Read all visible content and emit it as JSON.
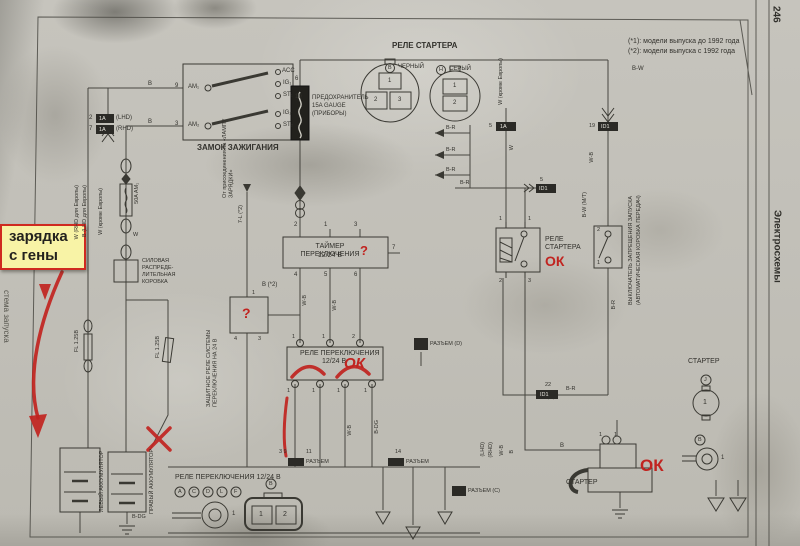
{
  "page": {
    "number": "246",
    "side_title": "Электросхемы",
    "left_edge_note": "стема запуска",
    "note1": "(*1): модели выпуска до 1992 года",
    "note2": "(*2): модели выпуска с 1992 года"
  },
  "sticky": {
    "line1": "зарядка",
    "line2": "с гены"
  },
  "red": {
    "ok": "ОК",
    "q": "?"
  },
  "ignition": {
    "title": "ЗАМОК ЗАЖИГАНИЯ",
    "am1": "AM₁",
    "am2": "AM₂",
    "acc": "ACC",
    "ig1": "IG₁",
    "st1": "ST₁",
    "ig2": "IG₂",
    "st2": "ST₂",
    "pin9": "9",
    "pin3": "3",
    "pin6": "6",
    "pin10": "10",
    "wire_b1": "B",
    "wire_b2": "B",
    "conn1": "2",
    "conn2": "7",
    "conn_name": "1A",
    "lhd": "(LHD)",
    "rhd": "(RHD)"
  },
  "fuse": {
    "name": "ПРЕДОХРАНИТЕЛЬ",
    "rating": "15A GAUGE",
    "note": "(ПРИБОРЫ)"
  },
  "relay_conn": {
    "title": "РЕЛЕ СТАРТЕРА",
    "black_l": "B",
    "black": "ЧЕРНЫЙ",
    "gray_l": "H",
    "gray": "СЕРЫЙ",
    "p1": "1",
    "p2": "2",
    "p3": "3",
    "q1": "1",
    "q2": "2",
    "side": "W (кроме Европы)"
  },
  "timer": {
    "name1": "ТАЙМЕР ПЕРЕКЛЮЧЕНИЯ",
    "name2": "12/24 В",
    "t1": "2",
    "t2": "1",
    "t3": "3",
    "b1": "4",
    "b2": "5",
    "b3": "6",
    "r1": "7",
    "note": "B (*2)"
  },
  "guard": {
    "name": "ЗАЩИТНОЕ РЕЛЕ СИСТЕМЫ ПЕРЕКЛЮЧЕНИЯ НА 24 В",
    "from": "От присоединения на «ЛАМПУ ЗАРЯДКИ»",
    "wire": "7-L (*2)",
    "p1": "1",
    "p4": "4",
    "p3": "3"
  },
  "swrelay": {
    "name1": "РЕЛЕ ПЕРЕКЛЮЧЕНИЯ",
    "name2": "12/24 В",
    "t1": "1",
    "t2": "1",
    "t3": "2",
    "b1": "1",
    "b2": "1",
    "b3": "1",
    "b4": "1"
  },
  "strelay": {
    "name1": "РЕЛЕ",
    "name2": "СТАРТЕРА",
    "p1": "1",
    "p2": "1",
    "p3": "2",
    "p4": "3"
  },
  "nswitch": {
    "name1": "ВЫКЛЮЧАТЕЛЬ ЗАПРЕЩЕНИЯ ЗАПУСКА",
    "name2": "(АВТОМАТИЧЕСКАЯ КОРОБКА ПЕРЕДАЧ)",
    "p2": "2",
    "p1": "1",
    "wire": "B-W (М/Т)"
  },
  "pwrbox": {
    "l1": "СИЛОВАЯ",
    "l2": "РАСПРЕДЕ-",
    "l3": "ЛИТЕЛЬНАЯ",
    "l4": "КОРОБКА",
    "fuse": "50A AM₁",
    "w": "W"
  },
  "leftcol": {
    "l1": "W (RHD для Европы)",
    "l2": "B (LHD для Европы)",
    "l3": "W (кроме Европы)",
    "fl1": "FL 1.25B",
    "fl2": "FL 1.25B"
  },
  "bat": {
    "left": "ЛЕВЫЙ АККУМУЛЯТОР",
    "right": "ПРАВЫЙ АККУМУЛЯТОР",
    "wire": "B-DG"
  },
  "panel": {
    "title": "РЕЛЕ ПЕРЕКЛЮЧЕНИЯ 12/24 В",
    "a": "A",
    "c": "C",
    "d": "D",
    "l": "L",
    "f": "F",
    "ring": "1",
    "cb": "B",
    "c1": "1",
    "c2": "2",
    "p39": "3  9",
    "p11": "11",
    "p14": "14"
  },
  "startb": {
    "name": "СТАРТЕР",
    "p1": "1",
    "p2": "1",
    "b": "B"
  },
  "startr": {
    "name": "СТАРТЕР",
    "j": "J",
    "b": "B",
    "pin": "1",
    "ring": "1"
  },
  "conn": {
    "c5a": "5",
    "c5a_n": "1A",
    "c19": "19",
    "c19_n": "ID1",
    "c5d": "5",
    "c5d_n": "ID1",
    "c22": "22",
    "c22_n": "ID1",
    "rd": "РАЗЪЕМ (D)",
    "r1": "РАЗЪЕМ",
    "r2": "РАЗЪЕМ",
    "rc": "РАЗЪЕМ (C)"
  },
  "wl": {
    "bw": "B-W",
    "br": "B-R",
    "br2": "B-R",
    "br3": "B-R",
    "br4": "B-R",
    "wb": "W-B",
    "wb2": "W-B",
    "wb3": "W-B",
    "wb4": "W-B",
    "w": "W",
    "b": "B",
    "bdg": "B-DG",
    "br5": "B-R",
    "lhd": "(LHD)",
    "rhd": "(RHD)"
  }
}
